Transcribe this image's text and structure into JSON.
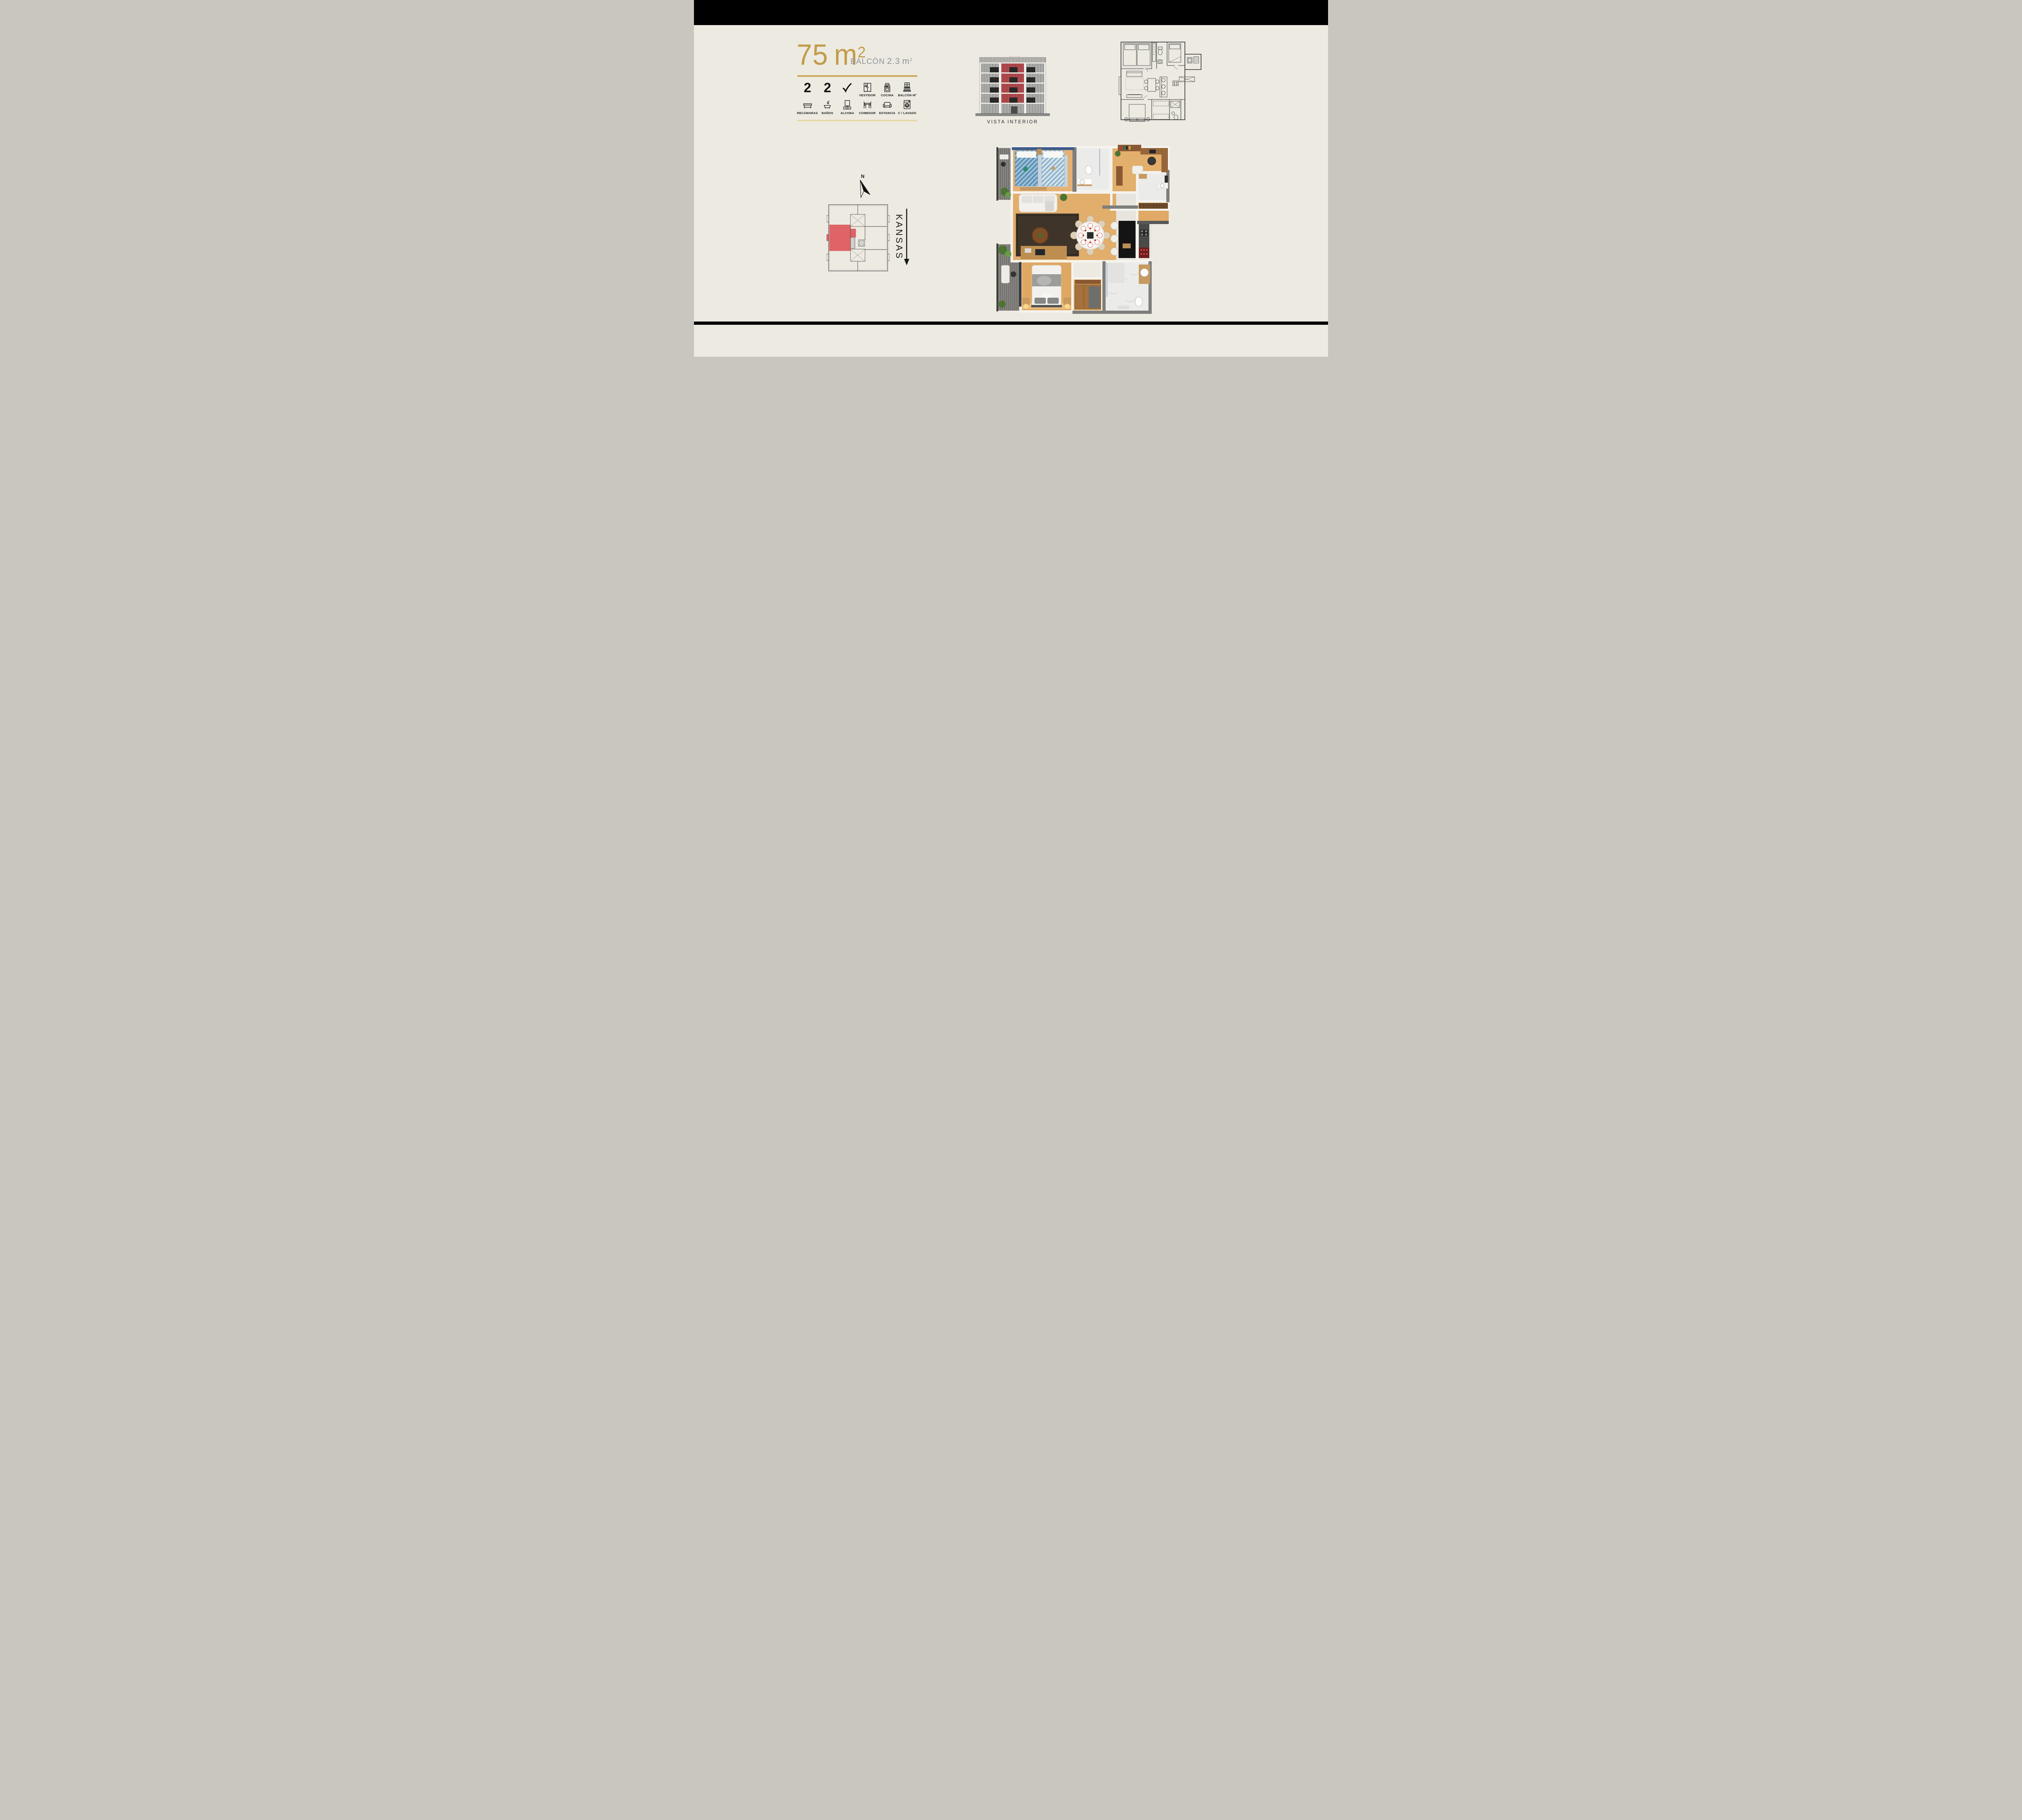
{
  "slide": {
    "background": "#EDEAE2",
    "top_bar_color": "#000000",
    "divider_color": "#000000"
  },
  "summary": {
    "area": {
      "value": "75",
      "unit": "m",
      "sup": "2"
    },
    "balcony": {
      "label": "BALCÓN",
      "value": "2.3",
      "unit": "m",
      "sup": "2"
    },
    "colors": {
      "gold": "#C29C49",
      "tan_rule": "#E9D8A6",
      "gray_text": "#8F9296"
    }
  },
  "features": {
    "row1": [
      {
        "type": "count",
        "value": "2"
      },
      {
        "type": "count",
        "value": "2"
      },
      {
        "type": "check",
        "value": "✓"
      },
      {
        "type": "icon",
        "icon": "wardrobe-icon",
        "label": "VESTIDOR"
      },
      {
        "type": "icon",
        "icon": "stove-icon",
        "label": "COCINA"
      },
      {
        "type": "icon",
        "icon": "balcony-icon",
        "label": "BALCÓN M²"
      }
    ],
    "row2": [
      {
        "icon": "bed-icon",
        "label": "RECÁMARAS"
      },
      {
        "icon": "bathtub-icon",
        "label": "BAÑOS"
      },
      {
        "icon": "tv-console-icon",
        "label": "ALCOBA"
      },
      {
        "icon": "dining-set-icon",
        "label": "COMEDOR"
      },
      {
        "icon": "sofa-icon",
        "label": "ESTANCIA"
      },
      {
        "icon": "washing-machine-icon",
        "label": "C / LAVADO"
      }
    ]
  },
  "elevation": {
    "caption": "VISTA INTERIOR",
    "highlight_color": "#B54B4F",
    "facade_color": "#AFAFAD",
    "floors_total": 5,
    "highlighted_floors": 4
  },
  "keyplan": {
    "compass_label": "N",
    "street_label": "KANSAS",
    "highlight_color": "#E06467"
  },
  "floorplan3d": {
    "wood_color": "#E2AE6C",
    "marble_color": "#EBEBE9",
    "rug_color": "#3E342A",
    "accent_wall_color": "#3D5B8B"
  }
}
